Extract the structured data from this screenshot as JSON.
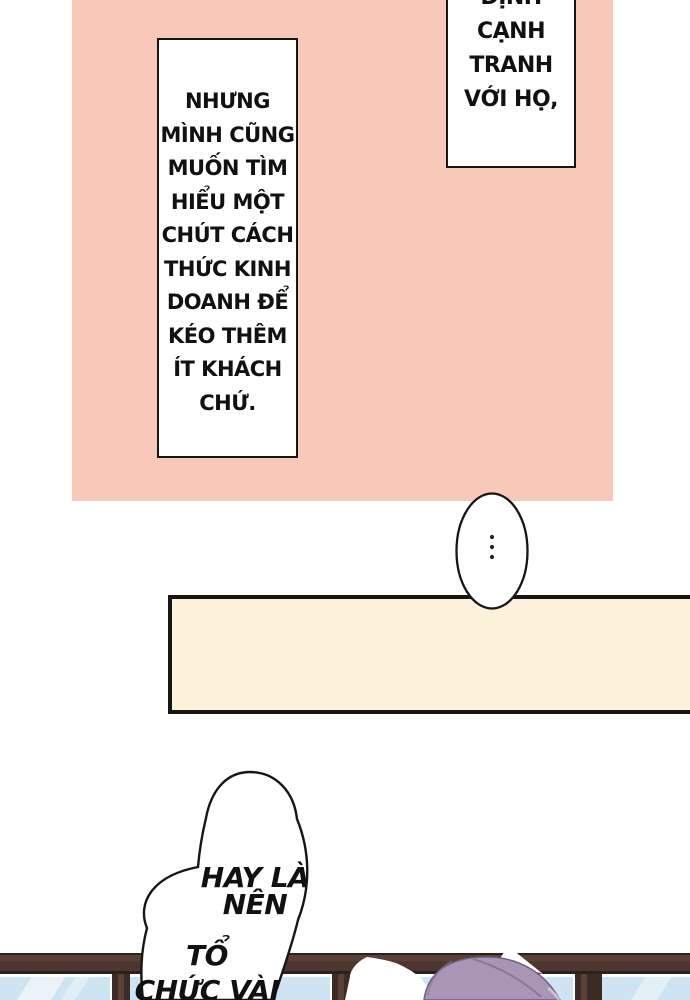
{
  "page": {
    "type": "comic-page",
    "language": "vi"
  },
  "colors": {
    "panel_pink": "#f8c8b8",
    "caption_cream": "#fcf2d9",
    "pane_blue": "#cfe4f2",
    "frame_brown": "#4e3630",
    "hair_purple": "#a996b7",
    "ink": "#161616"
  },
  "bubbles": {
    "top_right": {
      "lines": [
        "ĐỊNH",
        "CẠNH",
        "TRANH",
        "VỚI HỌ,"
      ]
    },
    "left": {
      "lines": [
        "NHƯNG",
        "MÌNH CŨNG",
        "MUỐN TÌM",
        "HIỂU MỘT",
        "CHÚT CÁCH",
        "THỨC KINH",
        "DOANH ĐỂ",
        "KÉO THÊM",
        "ÍT KHÁCH",
        "CHỨ."
      ]
    },
    "ellipsis": {
      "symbol": "...",
      "dot_count": 3
    },
    "bottom": {
      "group1": {
        "lines": [
          "HAY LÀ",
          "NÊN"
        ]
      },
      "group2": {
        "lines": [
          "TỔ",
          "CHỨC VÀI"
        ]
      }
    }
  }
}
